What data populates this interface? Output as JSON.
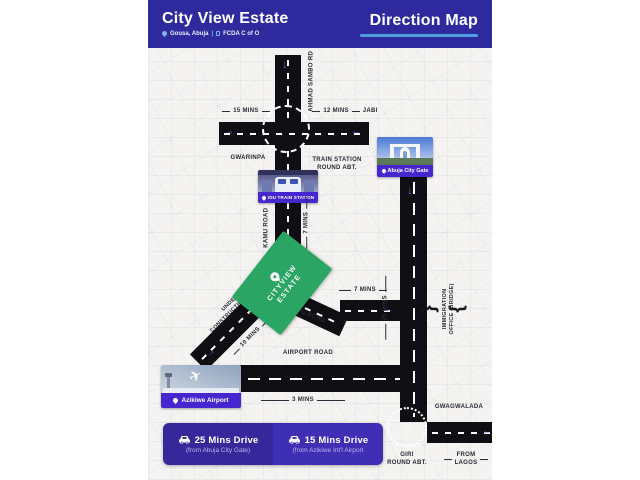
{
  "header": {
    "title": "City View Estate",
    "location": "Gousa, Abuja",
    "divider": "|",
    "certificate": "FCDA C of O",
    "map_title": "Direction Map"
  },
  "map": {
    "ahmad_sambo_rd": "AHMAD SAMBO RD",
    "mins_15": "15 MINS",
    "mins_12": "12 MINS",
    "jabi": "JABI",
    "gwarinpa": "GWARINPA",
    "train_station_line1": "TRAIN STATION",
    "train_station_line2": "ROUND ABT.",
    "idu_station_label": "IDU TRAIN STATION",
    "kamu_road_vertical": "KAMU ROAD",
    "mins_7_vertical": "7 MINS",
    "city_gate_label": "Abuja City Gate",
    "mins_25": "25 MINS",
    "estate_badge_line1": "CITYVIEW",
    "estate_badge_line2": "ESTATE",
    "mins_7_horizontal": "7 MINS",
    "kamu_road_diagonal": "KAMU ROAD",
    "immigration_line1": "IMMIGRATION",
    "immigration_line2": "OFFICE (BRIDGE)",
    "under_construction_line1": "UNDER",
    "under_construction_line2": "CONSTRUCTION ROAD",
    "mins_10": "10 MINS",
    "airport_road": "AIRPORT ROAD",
    "airport_label": "Azikiwe Airport",
    "mins_3": "3 MINS",
    "gwagwalada": "GWAGWALADA",
    "giri_line1": "GIRI",
    "giri_line2": "ROUND ABT.",
    "from_lagos_line1": "FROM",
    "from_lagos_line2": "LAGOS"
  },
  "icons": {
    "down_arrow": "↓",
    "left_arrow": "←",
    "right_arrow": "→",
    "bridge_brace_left": "{",
    "bridge_brace_right": "}"
  },
  "footer_cards": {
    "left": {
      "title": "25 Mins Drive",
      "subtitle": "(from Abuja City Gate)"
    },
    "right": {
      "title": "15 Mins Drive",
      "subtitle": "(from Azikiwe Int'l Airport"
    }
  },
  "colors": {
    "header_bg": "#2e2a9d",
    "underline_blue": "#4f9fe0",
    "poi_label_bg": "#4526cf",
    "estate_green": "#2aa564",
    "road_black": "#0e0e13",
    "arrow_blue": "#5468d4",
    "footer_left_bg": "#36289b",
    "footer_right_bg": "#3e2fb4",
    "map_bg": "#f4f3f1",
    "label_text": "#262b36"
  }
}
